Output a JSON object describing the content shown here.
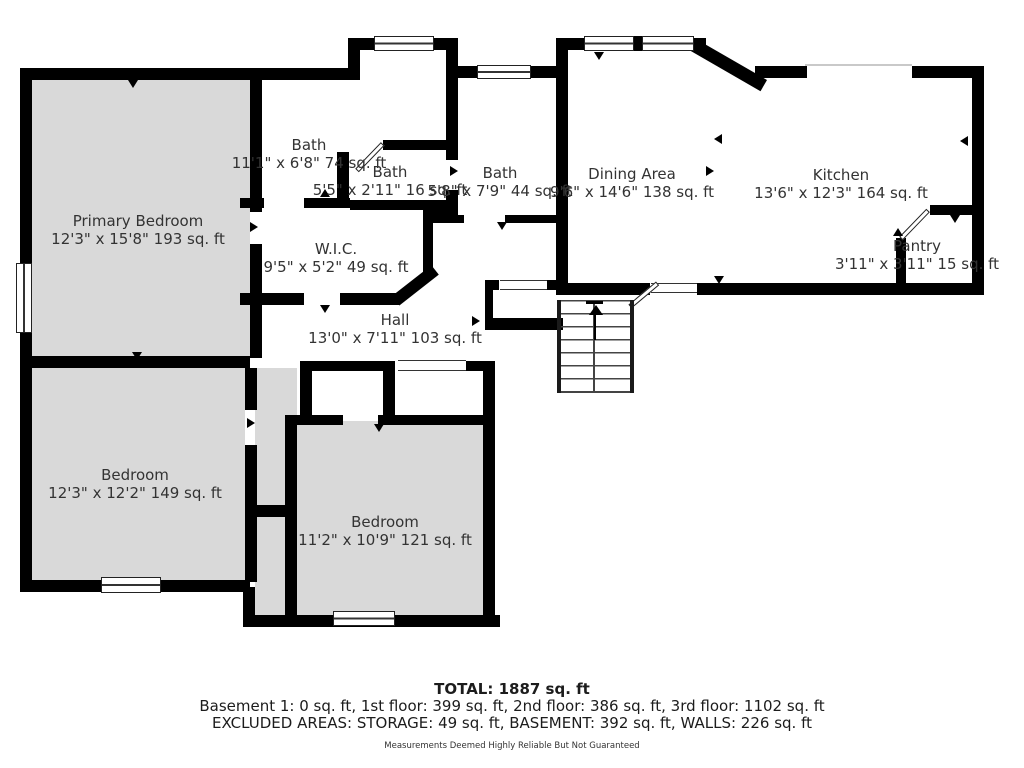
{
  "rooms": {
    "primary_bedroom": {
      "name": "Primary Bedroom",
      "dims": "12'3\" x 15'8\" 193 sq. ft"
    },
    "bath_1": {
      "name": "Bath",
      "dims": "11'1\" x 6'8\" 74 sq. ft"
    },
    "bath_2": {
      "name": "Bath",
      "dims": "5'5\" x 2'11\" 16 sq. ft"
    },
    "bath_3": {
      "name": "Bath",
      "dims": "5'8\" x 7'9\" 44 sq. ft"
    },
    "wic": {
      "name": "W.I.C.",
      "dims": "9'5\" x 5'2\" 49 sq. ft"
    },
    "hall": {
      "name": "Hall",
      "dims": "13'0\" x 7'11\" 103 sq. ft"
    },
    "dining": {
      "name": "Dining Area",
      "dims": "9'6\" x 14'6\" 138 sq. ft"
    },
    "kitchen": {
      "name": "Kitchen",
      "dims": "13'6\" x 12'3\" 164 sq. ft"
    },
    "pantry": {
      "name": "Pantry",
      "dims": "3'11\" x 3'11\" 15 sq. ft"
    },
    "bedroom_left": {
      "name": "Bedroom",
      "dims": "12'3\" x 12'2\" 149 sq. ft"
    },
    "bedroom_bottom": {
      "name": "Bedroom",
      "dims": "11'2\" x 10'9\" 121 sq. ft"
    }
  },
  "summary": {
    "total": "TOTAL: 1887 sq. ft",
    "floors": "Basement 1: 0 sq. ft, 1st floor: 399 sq. ft, 2nd floor: 386 sq. ft, 3rd floor: 1102 sq. ft",
    "excluded": "EXCLUDED AREAS: STORAGE: 49 sq. ft, BASEMENT: 392 sq. ft, WALLS: 226 sq. ft",
    "disclaimer": "Measurements Deemed Highly Reliable But Not Guaranteed"
  },
  "colors": {
    "wall": "#000000",
    "carpet": "#d9d9d9",
    "text": "#333333"
  }
}
